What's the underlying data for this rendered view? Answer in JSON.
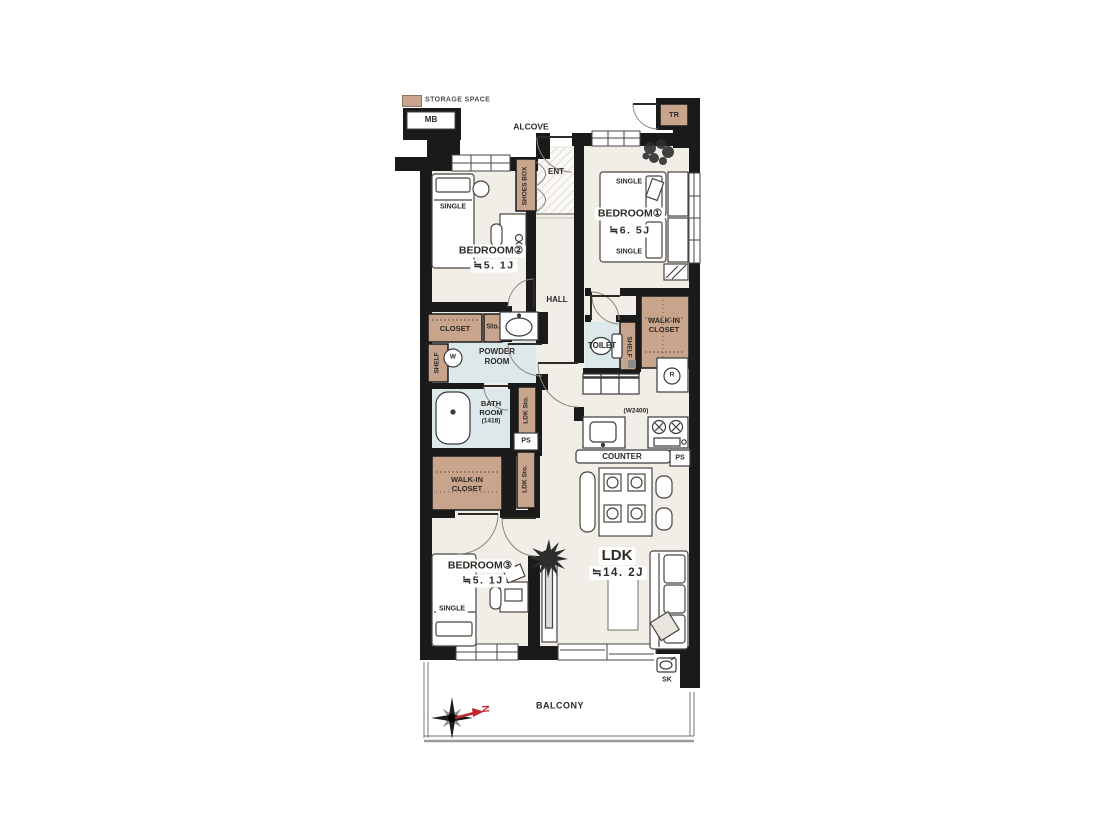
{
  "legend": {
    "storage_space": "STORAGE SPACE"
  },
  "exterior": {
    "mb": "MB",
    "alcove": "ALCOVE",
    "tr": "TR",
    "balcony": "BALCONY",
    "sk": "SK",
    "north": "N"
  },
  "entry": {
    "shoes_box": "SHOES BOX",
    "ent": "ENT",
    "hall": "HALL"
  },
  "rooms": {
    "bedroom1": {
      "name": "BEDROOM①",
      "size": "≒6. 5J",
      "bed1": "SINGLE",
      "bed2": "SINGLE"
    },
    "bedroom2": {
      "name": "BEDROOM②",
      "size": "≒5. 1J",
      "bed": "SINGLE"
    },
    "bedroom3": {
      "name": "BEDROOM③",
      "size": "≒5. 1J",
      "bed": "SINGLE"
    },
    "ldk": {
      "name": "LDK",
      "size": "≒14. 2J",
      "counter": "COUNTER",
      "kitchen_width": "(W2400)",
      "sto_upper": "LDK Sto.",
      "sto_lower": "LDK Sto.",
      "ps_upper": "PS",
      "ps_lower": "PS"
    }
  },
  "wet": {
    "powder1": "POWDER",
    "powder2": "ROOM",
    "toilet": "TOILET",
    "bath1": "BATH",
    "bath2": "ROOM",
    "bath3": "(1418)",
    "washer": "W",
    "fridge": "R"
  },
  "storage": {
    "closet": "CLOSET",
    "sto": "Sto.",
    "shelf_left": "SHELF",
    "shelf_right": "SHELF",
    "wic_top1": "WALK-IN",
    "wic_top2": "CLOSET",
    "wic_bottom1": "WALK-IN",
    "wic_bottom2": "CLOSET"
  },
  "colors": {
    "wall": "#1a1a1a",
    "storage": "#c9a48c",
    "wet": "#dce8ea",
    "floor": "#f1eee8",
    "line": "#4a4440",
    "north_red": "#c1272d"
  }
}
